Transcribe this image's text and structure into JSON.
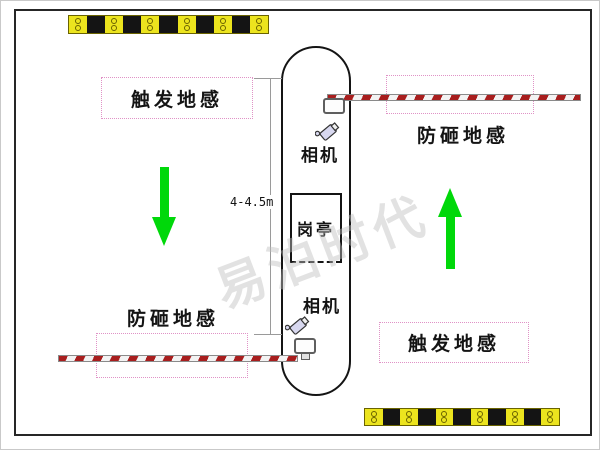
{
  "diagram": {
    "watermark": "易泊时代",
    "dimension_label": "4-4.5m",
    "booth_label": "岗亭",
    "cameras": {
      "top": "相机",
      "bottom": "相机"
    },
    "loops": {
      "top_left": "触发地感",
      "top_right": "防砸地感",
      "bottom_left": "防砸地感",
      "bottom_right": "触发地感"
    },
    "icons": {
      "left_lane_arrow": "arrow-down",
      "right_lane_arrow": "arrow-up",
      "speed_bumps": 2,
      "barrier_gates": 2,
      "cameras": 2
    },
    "colors": {
      "loop_border": "#e092c6",
      "arrow_green": "#00d80a",
      "barrier_red": "#a81e1e",
      "speed_bump_yellow": "#ece41e",
      "outline_black": "#141414"
    }
  }
}
